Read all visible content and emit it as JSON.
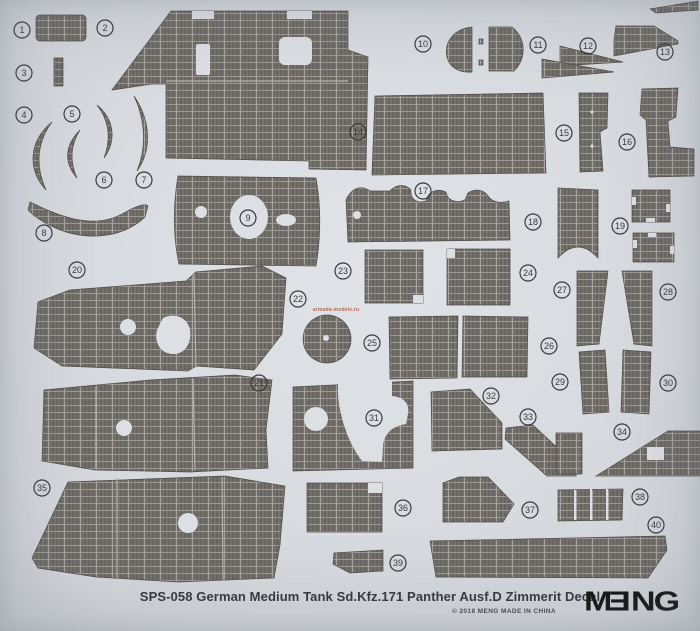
{
  "sheet": {
    "title": "SPS-058 German Medium Tank Sd.Kfz.171 Panther Ausf.D Zimmerit Decal",
    "copyright_line": "© 2018 MENG  MADE IN CHINA",
    "brand": "MENG",
    "watermark": "armada-models.ru"
  },
  "colors": {
    "background": "#d9dce1",
    "hole": "#dcdfe4",
    "piece_base": "#6e6a66",
    "ridge_dark": "#5c5854",
    "ridge_light": "#817d78",
    "row_line": "#a19d97",
    "col_line": "#aba69f",
    "piece_outline": "#4f4b47",
    "joint_line": "#b7b3ad",
    "badge": "#3a3a3c",
    "title_text": "#36363a",
    "logo": "#141414",
    "watermark_color": "#b26a52"
  },
  "piece_numbers": [
    {
      "n": "1",
      "x": 22,
      "y": 30
    },
    {
      "n": "2",
      "x": 105,
      "y": 28
    },
    {
      "n": "3",
      "x": 24,
      "y": 73
    },
    {
      "n": "4",
      "x": 24,
      "y": 115
    },
    {
      "n": "5",
      "x": 72,
      "y": 114
    },
    {
      "n": "6",
      "x": 104,
      "y": 180
    },
    {
      "n": "7",
      "x": 144,
      "y": 180
    },
    {
      "n": "8",
      "x": 44,
      "y": 233
    },
    {
      "n": "9",
      "x": 248,
      "y": 218
    },
    {
      "n": "10",
      "x": 423,
      "y": 44
    },
    {
      "n": "11",
      "x": 538,
      "y": 45
    },
    {
      "n": "12",
      "x": 588,
      "y": 46
    },
    {
      "n": "13",
      "x": 665,
      "y": 52
    },
    {
      "n": "14",
      "x": 358,
      "y": 132
    },
    {
      "n": "15",
      "x": 564,
      "y": 133
    },
    {
      "n": "16",
      "x": 627,
      "y": 142
    },
    {
      "n": "17",
      "x": 423,
      "y": 191
    },
    {
      "n": "18",
      "x": 533,
      "y": 222
    },
    {
      "n": "19",
      "x": 620,
      "y": 226
    },
    {
      "n": "20",
      "x": 77,
      "y": 270
    },
    {
      "n": "21",
      "x": 259,
      "y": 383
    },
    {
      "n": "22",
      "x": 298,
      "y": 299
    },
    {
      "n": "23",
      "x": 343,
      "y": 271
    },
    {
      "n": "24",
      "x": 528,
      "y": 273
    },
    {
      "n": "25",
      "x": 372,
      "y": 343
    },
    {
      "n": "26",
      "x": 549,
      "y": 346
    },
    {
      "n": "27",
      "x": 562,
      "y": 290
    },
    {
      "n": "28",
      "x": 668,
      "y": 292
    },
    {
      "n": "29",
      "x": 560,
      "y": 382
    },
    {
      "n": "30",
      "x": 668,
      "y": 383
    },
    {
      "n": "31",
      "x": 374,
      "y": 418
    },
    {
      "n": "32",
      "x": 491,
      "y": 396
    },
    {
      "n": "33",
      "x": 528,
      "y": 417
    },
    {
      "n": "34",
      "x": 622,
      "y": 432
    },
    {
      "n": "35",
      "x": 42,
      "y": 488
    },
    {
      "n": "36",
      "x": 403,
      "y": 508
    },
    {
      "n": "37",
      "x": 530,
      "y": 510
    },
    {
      "n": "38",
      "x": 640,
      "y": 497
    },
    {
      "n": "39",
      "x": 398,
      "y": 563
    },
    {
      "n": "40",
      "x": 656,
      "y": 525
    }
  ],
  "artwork": {
    "pieces": [
      {
        "d": "M40,15 h42 a4 4 0 0 1 4 4 v18 a4 4 0 0 1 -4 4 h-42 a4 4 0 0 1 -4 -4 v-18 a4 4 0 0 1 4 -4 z"
      },
      {
        "d": "M112,90 L171,11 L348,11 L348,50 L368,57 L366,170 L309,169 L309,161 L166,158 L166,84 L152,84 Z"
      },
      {
        "d": "M54,58 h9 v28 h-9 z"
      },
      {
        "d": "M52,122 C30,140 26,168 46,190 C35,166 37,142 52,122 Z"
      },
      {
        "d": "M80,130 C64,146 64,163 77,178 C69,160 71,144 80,130 Z"
      },
      {
        "d": "M97,105 C114,119 117,140 104,158 C112,137 108,119 97,105 Z"
      },
      {
        "d": "M134,96 C151,121 152,150 137,171 C147,147 145,119 134,96 Z"
      },
      {
        "d": "M30,202 C58,216 92,230 122,214 C136,206 145,203 148,206 L145,217 C126,235 96,241 66,232 C46,226 33,215 28,210 Z"
      },
      {
        "d": "M178,176 C173,205 173,236 179,264 L316,266 C321,236 321,206 316,178 Z"
      },
      {
        "d": "M472,27 C452,29 444,44 447,57 C450,69 461,73 472,72 Z"
      },
      {
        "d": "M489,27 L512,27 C526,38 527,58 514,71 L489,71 Z"
      },
      {
        "d": "M479,39 h4 v5 h-4 z"
      },
      {
        "d": "M479,60 h4 v5 h-4 z"
      },
      {
        "d": "M560,46 L623,62 L560,66 Z"
      },
      {
        "d": "M542,59 L614,72 L542,78 Z"
      },
      {
        "d": "M616,26 L654,26 L678,41 L678,44 L614,56 L614,40 Z"
      },
      {
        "d": "M650,9 L698,1 L698,10 L656,13 Z"
      },
      {
        "d": "M375,96 L543,93 L546,173 L372,175 Z"
      },
      {
        "d": "M579,93 L608,93 L607,128 L600,132 L603,171 L580,172 Z"
      },
      {
        "d": "M642,89 L678,88 L676,117 L668,121 L670,147 L694,149 L694,176 L649,177 L646,120 L640,115 Z"
      },
      {
        "d": "M346,200 C352,187 362,185 370,191 L390,191 C396,184 406,184 411,190 C410,199 417,204 426,201 C428,191 438,188 446,192 C447,200 456,204 465,200 L468,193 C476,188 484,190 488,196 C492,202 500,204 509,201 L510,240 L348,242 Z"
      },
      {
        "d": "M558,188 L598,190 L598,258 Q578,236 558,258 Z"
      },
      {
        "d": "M632,190 h38 v32 h-38 z"
      },
      {
        "d": "M633,233 h41 v29 h-41 z"
      },
      {
        "d": "M38,302 L70,290 L186,281 L196,272 L262,266 L286,278 L282,334 L254,370 L196,366 L188,371 L62,366 L34,348 Z"
      },
      {
        "d": "M44,390 L150,380 L235,375 L272,380 L266,430 L268,468 L190,472 L95,470 L42,461 Z"
      },
      {
        "d": "M327,315 a24,24 0 1 0 0.1,0 z"
      },
      {
        "d": "M365,250 h58 v53 h-58 z"
      },
      {
        "d": "M447,249 h63 v56 h-63 z"
      },
      {
        "d": "M389,317 L458,316 L457,378 L390,379 Z"
      },
      {
        "d": "M463,316 L528,317 L527,377 L462,377 Z"
      },
      {
        "d": "M577,271 L608,271 L599,344 L577,346 Z"
      },
      {
        "d": "M622,271 L652,271 L652,346 L634,344 Z"
      },
      {
        "d": "M579,352 L605,350 L609,412 L583,414 Z"
      },
      {
        "d": "M623,350 L651,352 L649,414 L621,412 Z"
      },
      {
        "d": "M293,387 L413,381 L413,468 L293,471 Z"
      },
      {
        "d": "M431,392 L470,389 L502,423 L502,449 L432,451 Z"
      },
      {
        "d": "M506,428 L533,425 L578,467 L576,476 L547,476 L505,439 Z"
      },
      {
        "d": "M556,433 h26 v41 h-26 z"
      },
      {
        "d": "M668,431 L700,431 L700,476 L596,476 Z"
      },
      {
        "d": "M68,482 L225,476 L285,486 L280,545 L274,578 L178,582 L96,577 L38,568 L32,558 Z"
      },
      {
        "d": "M307,483 h75 v49 h-75 z"
      },
      {
        "d": "M443,483 L459,477 L488,477 L514,504 L503,522 L443,522 Z"
      },
      {
        "d": "M558,490 L623,489 L622,520 L558,521 Z"
      },
      {
        "d": "M334,553 L383,550 L383,571 L350,573 L333,564 Z"
      },
      {
        "d": "M430,541 L665,536 L667,550 L648,578 L436,577 Z"
      }
    ],
    "holes": [
      {
        "type": "rect",
        "x": 196,
        "y": 44,
        "w": 14,
        "h": 31,
        "rx": 2
      },
      {
        "type": "rect",
        "x": 279,
        "y": 37,
        "w": 33,
        "h": 28,
        "rx": 6
      },
      {
        "type": "rect",
        "x": 192,
        "y": 11,
        "w": 22,
        "h": 8
      },
      {
        "type": "rect",
        "x": 287,
        "y": 11,
        "w": 25,
        "h": 8
      },
      {
        "type": "circle",
        "cx": 201,
        "cy": 212,
        "r": 6
      },
      {
        "type": "ellipse",
        "cx": 249,
        "cy": 217,
        "rx": 19,
        "ry": 22
      },
      {
        "type": "ellipse",
        "cx": 286,
        "cy": 220,
        "rx": 10,
        "ry": 6
      },
      {
        "type": "circle",
        "cx": 592,
        "cy": 112,
        "r": 1.5
      },
      {
        "type": "circle",
        "cx": 592,
        "cy": 146,
        "r": 1.5
      },
      {
        "type": "circle",
        "cx": 357,
        "cy": 215,
        "r": 4
      },
      {
        "type": "rect",
        "x": 632,
        "y": 197,
        "w": 4,
        "h": 8
      },
      {
        "type": "rect",
        "x": 666,
        "y": 204,
        "w": 4,
        "h": 8
      },
      {
        "type": "rect",
        "x": 646,
        "y": 218,
        "w": 9,
        "h": 4
      },
      {
        "type": "rect",
        "x": 633,
        "y": 240,
        "w": 4,
        "h": 8
      },
      {
        "type": "rect",
        "x": 670,
        "y": 246,
        "w": 4,
        "h": 8
      },
      {
        "type": "rect",
        "x": 648,
        "y": 233,
        "w": 8,
        "h": 4
      },
      {
        "type": "circle",
        "cx": 128,
        "cy": 327,
        "r": 8
      },
      {
        "type": "path",
        "d": "M163,318 C175,312 188,318 190,330 C192,344 184,355 172,354 C160,353 154,342 157,330 Z"
      },
      {
        "type": "circle",
        "cx": 124,
        "cy": 428,
        "r": 8
      },
      {
        "type": "circle",
        "cx": 326,
        "cy": 338,
        "r": 3
      },
      {
        "type": "rect",
        "x": 413,
        "y": 295,
        "w": 10,
        "h": 8
      },
      {
        "type": "rect",
        "x": 447,
        "y": 249,
        "w": 8,
        "h": 9
      },
      {
        "type": "circle",
        "cx": 316,
        "cy": 419,
        "r": 12
      },
      {
        "type": "path",
        "d": "M338,381 L392,381 L392,396 C404,397 410,404 408,414 L406,424 C392,426 384,434 383,446 L382,462 L362,461 C346,440 339,412 338,394 Z"
      },
      {
        "type": "rect",
        "x": 647,
        "y": 447,
        "w": 17,
        "h": 13
      },
      {
        "type": "circle",
        "cx": 188,
        "cy": 523,
        "r": 10
      },
      {
        "type": "rect",
        "x": 368,
        "y": 483,
        "w": 14,
        "h": 10
      },
      {
        "type": "rect",
        "x": 574,
        "y": 490,
        "w": 2,
        "h": 30
      },
      {
        "type": "rect",
        "x": 590,
        "y": 489,
        "w": 2,
        "h": 31
      },
      {
        "type": "rect",
        "x": 606,
        "y": 489,
        "w": 2,
        "h": 31
      }
    ],
    "joint_lines": [
      {
        "d": "M166,81 L348,81"
      },
      {
        "d": "M194,274 L196,368"
      },
      {
        "d": "M96,387 L96,469"
      },
      {
        "d": "M193,379 L195,470"
      },
      {
        "d": "M117,478 L117,578"
      },
      {
        "d": "M222,477 L223,580"
      }
    ]
  }
}
